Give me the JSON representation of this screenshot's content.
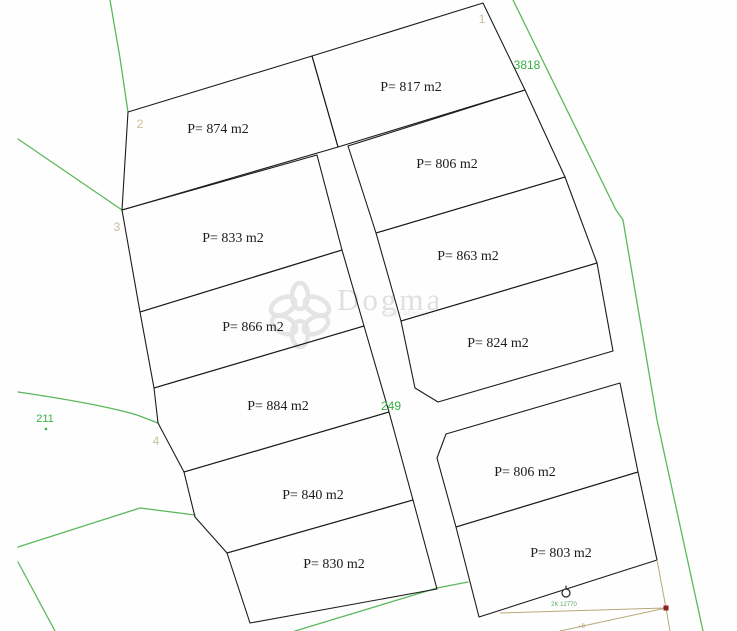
{
  "map": {
    "parcels": [
      {
        "number": "874",
        "area_label": "P= 874 m2"
      },
      {
        "number": "833",
        "area_label": "P= 833 m2"
      },
      {
        "number": "866",
        "area_label": "P= 866 m2"
      },
      {
        "number": "884",
        "area_label": "P= 884 m2"
      },
      {
        "number": "840",
        "area_label": "P= 840 m2"
      },
      {
        "number": "830",
        "area_label": "P= 830 m2"
      },
      {
        "number": "817",
        "area_label": "P= 817 m2"
      },
      {
        "number": "806u",
        "area_label": "P= 806 m2"
      },
      {
        "number": "863",
        "area_label": "P= 863 m2"
      },
      {
        "number": "824",
        "area_label": "P= 824 m2"
      },
      {
        "number": "806l",
        "area_label": "P= 806 m2"
      },
      {
        "number": "803",
        "area_label": "P= 803 m2"
      }
    ],
    "vertex_labels": [
      {
        "text": "1"
      },
      {
        "text": "2"
      },
      {
        "text": "3"
      },
      {
        "text": "4"
      }
    ],
    "neighbor_labels": [
      {
        "text": "3818"
      },
      {
        "text": "211"
      },
      {
        "text": "249"
      }
    ],
    "survey_marker": {
      "label": "2K 12770",
      "secondary_label": "+8"
    },
    "watermark": {
      "brand": "Dogma",
      "tagline": "nekretnine"
    },
    "colors": {
      "background": "#fefefe",
      "parcel_line": "#1c1c1c",
      "green_line": "#5cb85c",
      "green_text": "#35b043",
      "vertex_text": "#c9bf9b",
      "survey_line": "#b8a878",
      "red_marker": "#8b2222",
      "watermark": "#e2e2e2"
    }
  }
}
